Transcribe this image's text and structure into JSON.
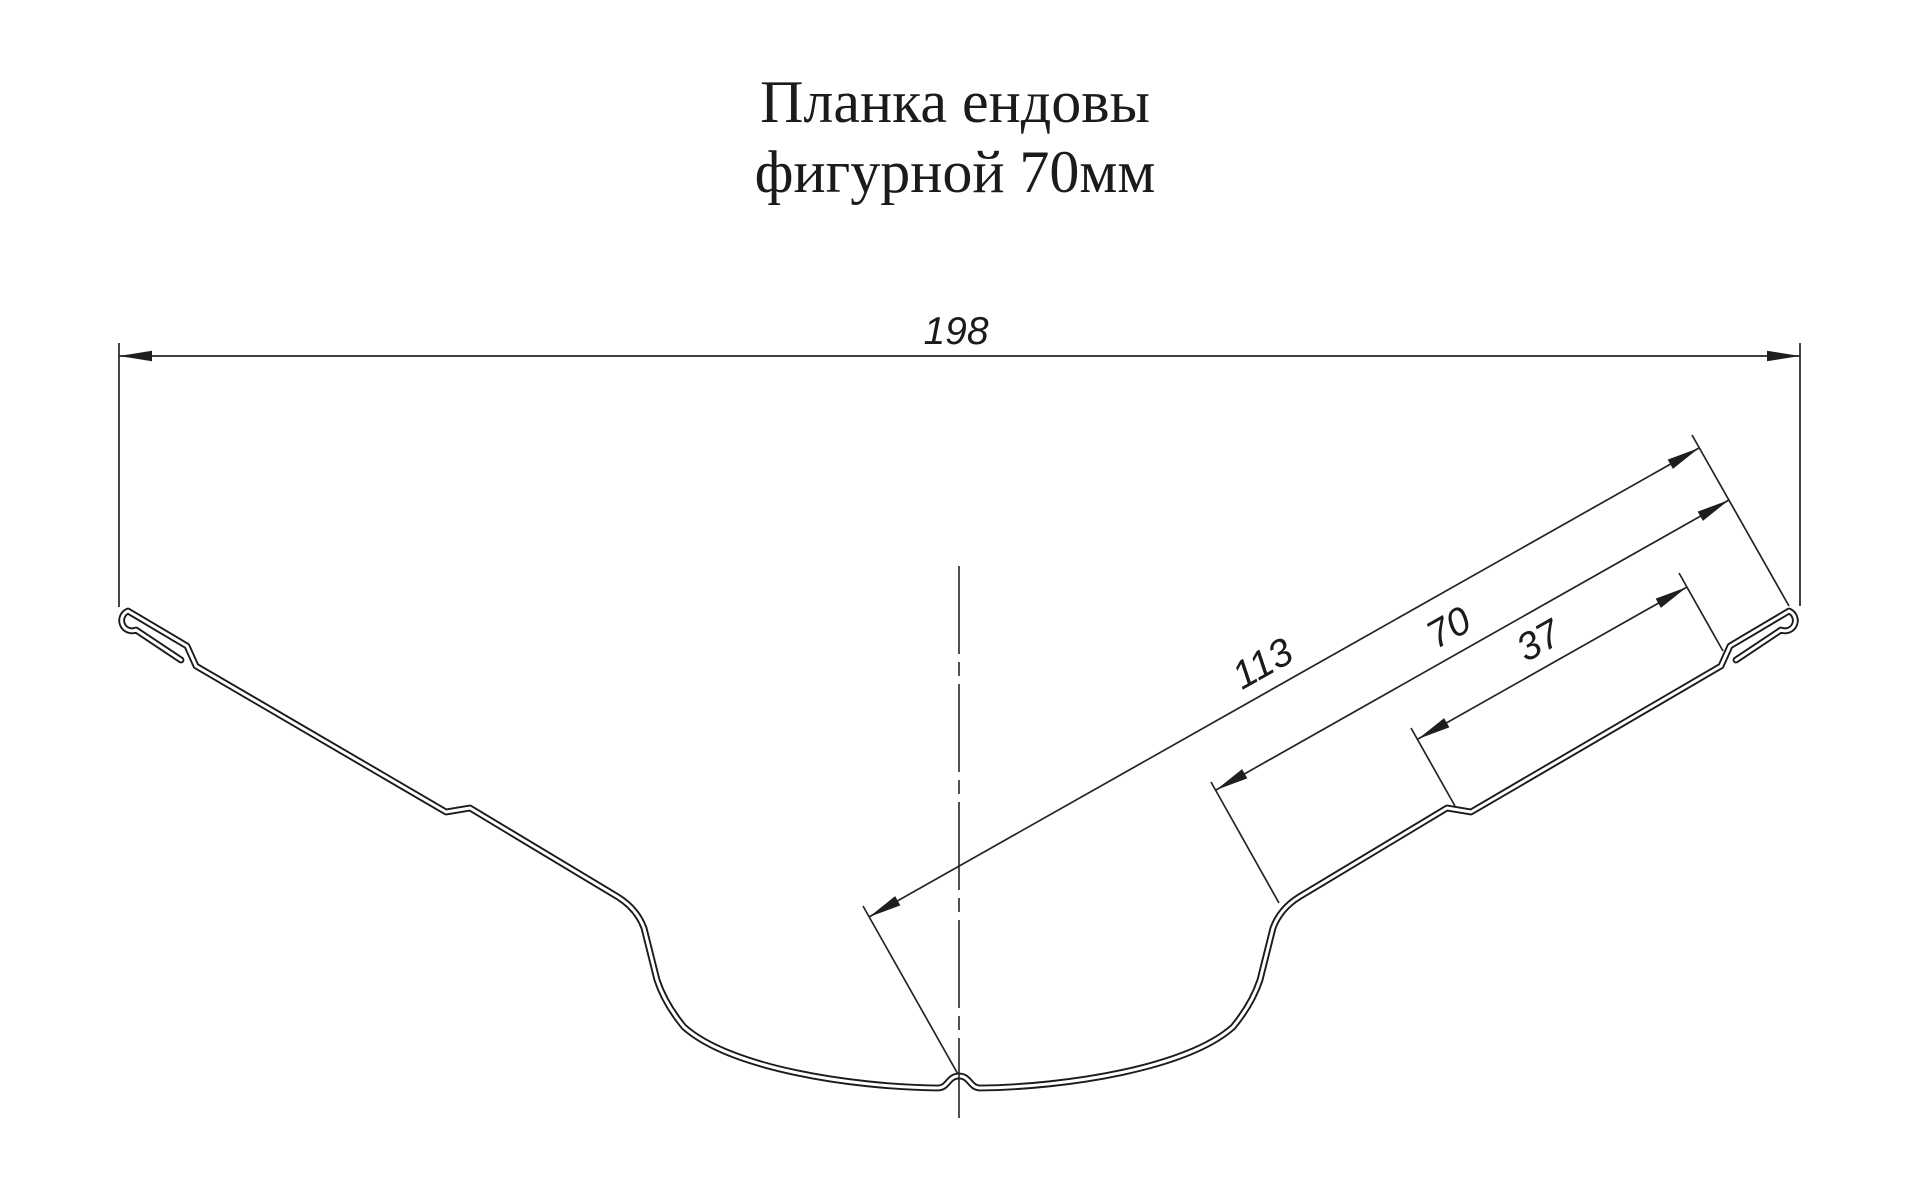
{
  "title": {
    "line1": "Планка ендовы",
    "line2": "фигурной 70мм"
  },
  "dimensions": {
    "total_width": {
      "label": "198",
      "orientation": "horizontal"
    },
    "slope_total": {
      "label": "113",
      "orientation": "along-slope"
    },
    "slope_outer": {
      "label": "70",
      "orientation": "along-slope"
    },
    "slope_step": {
      "label": "37",
      "orientation": "along-slope"
    }
  },
  "colors": {
    "line": "#1b1b1b",
    "background": "#ffffff"
  }
}
